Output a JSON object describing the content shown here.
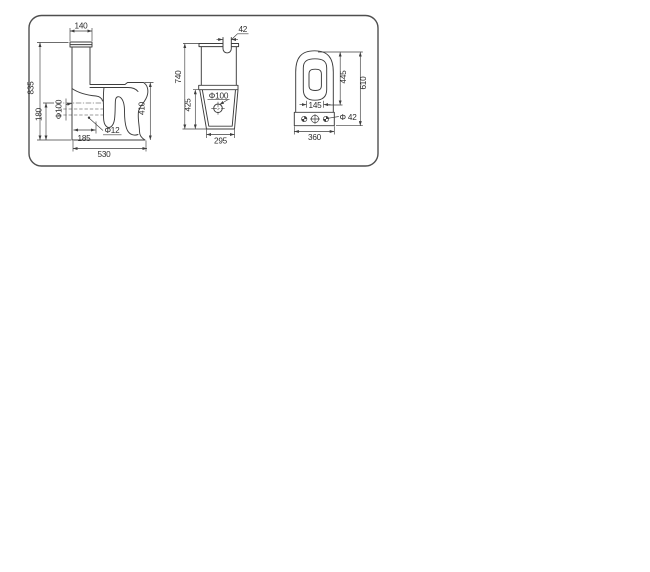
{
  "theme": {
    "line_color": "#3d3d3d",
    "text_color": "#2b2b2b",
    "border_color": "#4f4f4f",
    "background": "#ffffff"
  },
  "drawing": {
    "side_view": {
      "tank_width": "140",
      "total_height": "835",
      "outlet_height": "180",
      "outlet_diameter": "Φ100",
      "fixing_hole_diameter": "Φ12",
      "outlet_offset": "185",
      "total_depth": "530",
      "seat_height": "410"
    },
    "front_view": {
      "inlet_width": "42",
      "tank_height": "740",
      "base_height": "425",
      "drain_diameter": "Φ100",
      "base_width": "295"
    },
    "top_view": {
      "seat_length": "445",
      "total_depth": "610",
      "opening_width": "145",
      "tank_width": "360",
      "hole_diameter": "Φ 42"
    }
  }
}
